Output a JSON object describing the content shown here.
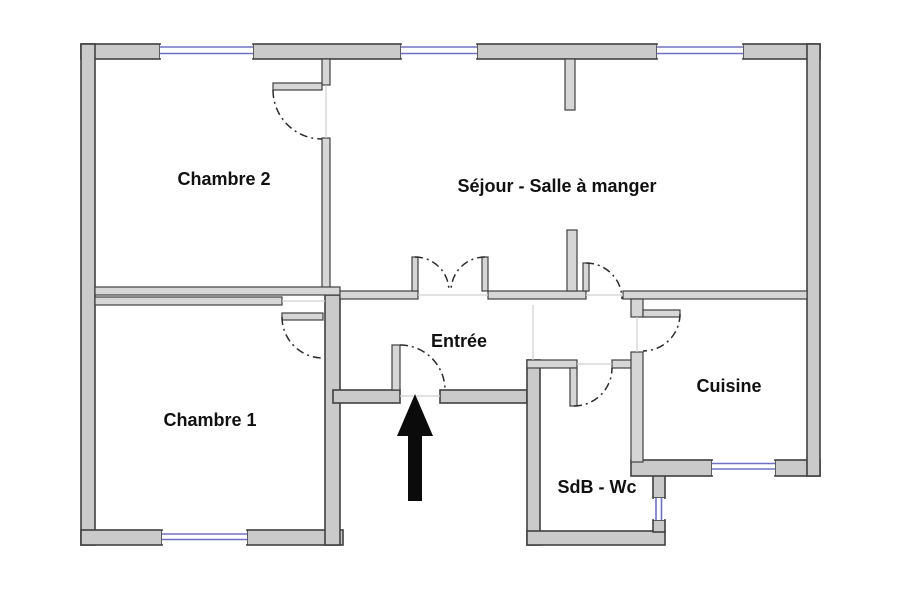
{
  "plan": {
    "rooms": [
      {
        "label": "Chambre 2"
      },
      {
        "label": "Séjour - Salle à manger"
      },
      {
        "label": "Entrée"
      },
      {
        "label": "Chambre 1"
      },
      {
        "label": "Cuisine"
      },
      {
        "label": "SdB - Wc"
      }
    ],
    "annotations": {
      "entrance_arrow": "entrance"
    },
    "colors": {
      "background": "#ffffff",
      "wall_fill": "#cacaca",
      "wall_int_fill": "#d6d6d6",
      "wall_outline": "#404040",
      "window": "#7070c2",
      "arrow": "#0b0b0b"
    }
  }
}
